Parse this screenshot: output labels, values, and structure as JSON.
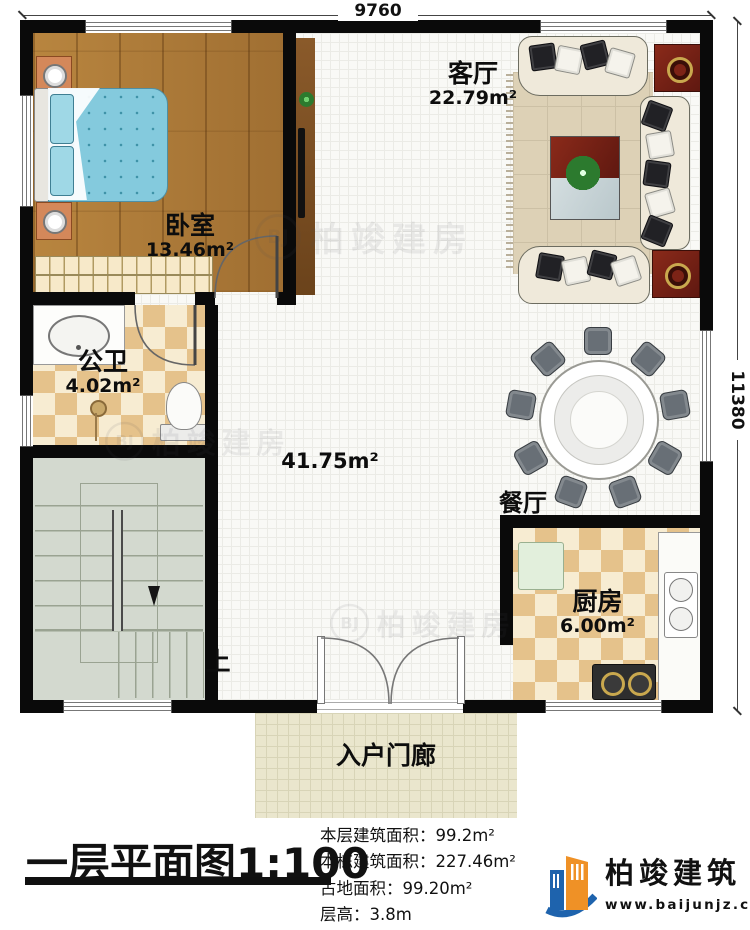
{
  "dim": {
    "top": "9760",
    "right": "11380"
  },
  "rooms": {
    "living": {
      "name": "客厅",
      "area": "22.79m²"
    },
    "bedroom": {
      "name": "卧室",
      "area": "13.46m²"
    },
    "bathroom": {
      "name": "公卫",
      "area": "4.02m²"
    },
    "hall": {
      "area": "41.75m²"
    },
    "dining": {
      "name": "餐厅"
    },
    "kitchen": {
      "name": "厨房",
      "area": "6.00m²"
    },
    "porch": {
      "name": "入户门廊"
    },
    "stairs": {
      "up": "上"
    }
  },
  "watermark": {
    "badge": "BJ",
    "text": "柏竣建房"
  },
  "footer": {
    "title": "一层平面图",
    "scale": "1:100",
    "stats": [
      {
        "label": "本层建筑面积：",
        "value": "99.2m²"
      },
      {
        "label": "本栋建筑面积：",
        "value": "227.46m²"
      },
      {
        "label": "占地面积：",
        "value": "99.20m²"
      },
      {
        "label": "层高：",
        "value": "3.8m"
      }
    ],
    "logo": {
      "name": "柏竣建筑",
      "website": "www.baijunjz.com"
    }
  },
  "colors": {
    "wall": "#0a0a0a",
    "wood_floor": "#b5813f",
    "checker_dark": "#e5c28b",
    "checker_light": "#f7ecd2",
    "stairs": "#d3d9cf",
    "porch": "#eae6cd",
    "bed": "#84cadd",
    "logo_blue": "#1e63ad",
    "logo_orange": "#ef9126"
  }
}
